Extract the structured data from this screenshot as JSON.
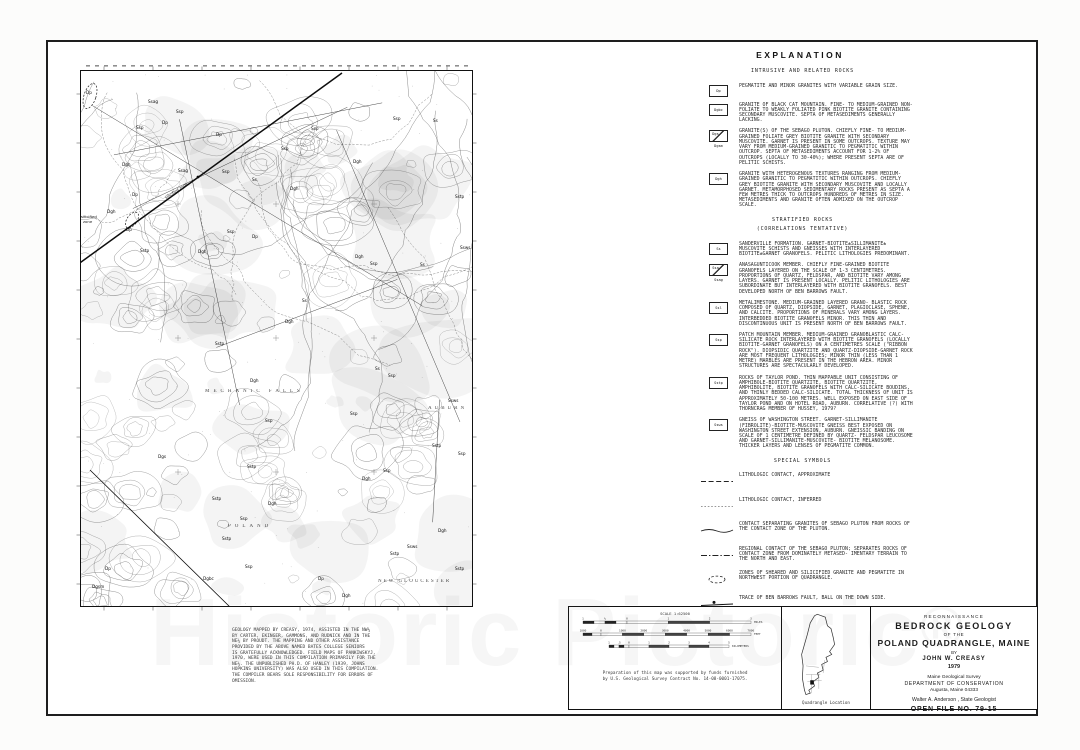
{
  "watermark": {
    "text": "Historic Pictoric",
    "reg": "®"
  },
  "explanation": {
    "title": "EXPLANATION",
    "sections": {
      "intrusive_header": "INTRUSIVE AND RELATED ROCKS",
      "stratified_header": "STRATIFIED ROCKS",
      "stratified_sub": "(CORRELATIONS TENTATIVE)",
      "symbols_header": "SPECIAL SYMBOLS"
    },
    "intrusive": [
      {
        "label": "Dp",
        "text": "PEGMATITE AND MINOR GRANITES WITH VARIABLE GRAIN SIZE."
      },
      {
        "label": "Dgbc",
        "text": "GRANITE OF BLACK CAT MOUNTAIN.  FINE- TO MEDIUM-GRAINED NON-FOLIATE TO WEAKLY FOLIATED PINK BIOTITE GRANITE CONTAINING SECONDARY MUSCOVITE.  SEPTA OF METASEDIMENTS GENERALLY LACKING."
      },
      {
        "label": "Dgs",
        "sublabel": "Dgsm",
        "text": "GRANITE(S) OF THE SEBAGO PLUTON.  CHIEFLY FINE- TO MEDIUM-GRAINED FOLIATE GREY BIOTITE GRANITE WITH SECONDARY MUSCOVITE.  GARNET IS PRESENT IN SOME OUTCROPS.  TEXTURE MAY VARY FROM MEDIUM-GRAINED GRANITIC TO PEGMATITIC WITHIN OUTCROP.  SEPTA OF METASEDIMENTS ACCOUNT FOR 1-2% OF OUTCROPS (LOCALLY TO 30-40%); WHERE PRESENT SEPTA ARE OF PELITIC SCHISTS."
      },
      {
        "label": "Dgh",
        "text": "GRANITE WITH HETEROGENOUS TEXTURES RANGING FROM MEDIUM-GRAINED GRANITIC TO PEGMATITIC WITHIN OUTCROPS.  CHIEFLY GREY BIOTITE GRANITE WITH SECONDARY MUSCOVITE AND LOCALLY GARNET.  METAMORPHOSED SEDIMENTARY ROCKS PRESENT AS SEPTA A FEW METRES THICK TO OUTCROPS HUNDREDS OF METRES IN SIZE.  METASEDIMENTS AND GRANITE OFTEN ADMIXED ON THE OUTCROP SCALE."
      }
    ],
    "stratified": [
      {
        "label": "Ss",
        "text": "SANDERVILLE FORMATION.  GARNET-BIOTITE±SILLIMANITE± MUSCOVITE SCHISTS AND GNEISSES WITH INTERLAYERED BIOTITE±GARNET GRANOFELS.  PELITIC LITHOLOGIES PREDOMINANT."
      },
      {
        "label": "Ssa",
        "sublabel": "Ssag",
        "text": "ANASAGUNTICOOK MEMBER.  CHIEFLY FINE-GRAINED BIOTITE GRANOFELS LAYERED ON THE SCALE OF 1-3 CENTIMETRES. PROPORTIONS OF QUARTZ, FELDSPAR, AND BIOTITE VARY AMONG LAYERS.  GARNET IS PRESENT LOCALLY.  PELITIC LITHOLOGIES ARE SUBORDINATE BUT INTERLAYERED WITH BIOTITE GRANOFELS.  BEST DEVELOPED NORTH OF BEN BARROWS FAULT."
      },
      {
        "label": "Ssl",
        "text": "METALIMESTONE.  MEDIUM-GRAINED LAYERED GRANO- BLASTIC ROCK COMPOSED OF QUARTZ, DIOPSIDE, GARNET, PLAGIOCLASE, SPHENE, AND CALCITE.  PROPORTIONS OF MINERALS VARY AMONG LAYERS.  INTERBEDDED BIOTITE GRANOFELS MINOR.  THIS THIN AND DISCONTINUOUS UNIT IS PRESENT NORTH OF BEN BARROWS FAULT."
      },
      {
        "label": "Ssp",
        "text": "PATCH MOUNTAIN MEMBER.  MEDIUM-GRAINED GRANOBLASTIC CALC-SILICATE ROCK INTERLAYERED WITH BIOTITE GRANOFELS (LOCALLY BIOTITE-GARNET GRANOFELS) ON A CENTIMETRES SCALE (\"RIBBON ROCK\").  DIOPSIDIC QUARTZITE AND QUARTZ-DIOPSIDE-GARNET ROCK ARE MOST FREQUENT LITHOLOGIES; MINOR THIN (LESS THAN 1 METRE) MARBLES ARE PRESENT IN THE HEBRON AREA. MINOR STRUCTURES ARE SPECTACULARLY DEVELOPED."
      },
      {
        "label": "Sstp",
        "text": "ROCKS OF TAYLOR POND.  THIN MAPPABLE UNIT CONSISTING OF AMPHIBOLE-BIOTITE QUARTZITE, BIOTITE QUARTZITE, AMPHIBOLITE, BIOTITE GRANOFELS WITH CALC-SILICATE BOUDINS, AND THINLY BEDDED CALC-SILICATE.  TOTAL THICKNESS OF UNIT IS APPROXIMATELY 50-100 METRES. WELL EXPOSED ON EAST SIDE OF TAYLOR POND AND ON HOTEL ROAD, AUBURN.  CORRELATIVE (?) WITH THORNCRAG MEMBER OF HUSSEY, 1979?"
      },
      {
        "label": "Ssws",
        "text": "GNEISS OF WASHINGTON STREET.  GARNET-SILLIMANITE (FIBROLITE)-BIOTITE-MUSCOVITE GNEISS BEST EXPOSED ON WASHINGTON STREET EXTENSION, AUBURN.  GNEISSIC BANDING ON SCALE OF 1 CENTIMETRE DEFINED BY QUARTZ- FELDSPAR LEUCOSOME AND GARNET-SILLIMANITE-MUSCOVITE- BIOTITE MELANOSOME.  THICKER LAYERS AND LENSES OF PEGMATITE COMMON."
      }
    ],
    "symbols": [
      {
        "type": "dash",
        "text": "LITHOLOGIC CONTACT, APPROXIMATE"
      },
      {
        "type": "dot",
        "text": "LITHOLOGIC CONTACT, INFERRED"
      },
      {
        "type": "solid",
        "text": "CONTACT SEPARATING GRANITES OF SEBAGO PLUTON FROM ROCKS OF THE CONTACT ZONE OF THE PLUTON."
      },
      {
        "type": "dashdot",
        "text": "REGIONAL CONTACT OF THE SEBAGO PLUTON; SEPARATES ROCKS OF CONTACT ZONE FROM DOMINATELY METASED- IMENTARY TERRAIN TO THE NORTH AND EAST."
      },
      {
        "type": "ellipse",
        "text": "ZONES OF SHEARED AND SILICIFIED GRANITE AND PEGMATITE IN NORTHWEST PORTION OF QUADRANGLE."
      },
      {
        "type": "fault",
        "text": "TRACE OF BEN BARROWS FAULT, BALL ON THE DOWN SIDE."
      }
    ]
  },
  "map": {
    "place_names": [
      {
        "t": "MECHANIC FALLS",
        "x": 125,
        "y": 322,
        "ls": 4
      },
      {
        "t": "POLAND",
        "x": 148,
        "y": 457,
        "ls": 4
      },
      {
        "t": "AUBURN",
        "x": 348,
        "y": 339,
        "ls": 3
      },
      {
        "t": "NEW GLOUCESTER",
        "x": 298,
        "y": 512,
        "ls": 2
      }
    ],
    "annotations": [
      {
        "t": "silicified zone",
        "x": 86,
        "y": 129,
        "rot": -33
      },
      {
        "t": "silicified",
        "x": 1,
        "y": 148,
        "rot": 0
      },
      {
        "t": "zone",
        "x": 3,
        "y": 153,
        "rot": 0
      }
    ],
    "unit_labels": [
      {
        "t": "Dp",
        "x": 6,
        "y": 24
      },
      {
        "t": "Ssag",
        "x": 68,
        "y": 33
      },
      {
        "t": "Ssp",
        "x": 96,
        "y": 43
      },
      {
        "t": "Dp",
        "x": 82,
        "y": 54
      },
      {
        "t": "Ssp",
        "x": 56,
        "y": 59
      },
      {
        "t": "Dp",
        "x": 136,
        "y": 66
      },
      {
        "t": "Dgh",
        "x": 42,
        "y": 96
      },
      {
        "t": "Ssag",
        "x": 98,
        "y": 102
      },
      {
        "t": "Ssp",
        "x": 142,
        "y": 103
      },
      {
        "t": "Ss",
        "x": 172,
        "y": 111
      },
      {
        "t": "Dp",
        "x": 52,
        "y": 126
      },
      {
        "t": "Dgh",
        "x": 27,
        "y": 143
      },
      {
        "t": "Dp",
        "x": 46,
        "y": 161
      },
      {
        "t": "Sstp",
        "x": 60,
        "y": 182
      },
      {
        "t": "Ssp",
        "x": 201,
        "y": 80
      },
      {
        "t": "Ssp",
        "x": 231,
        "y": 60
      },
      {
        "t": "Dgh",
        "x": 273,
        "y": 93
      },
      {
        "t": "Ssp",
        "x": 313,
        "y": 50
      },
      {
        "t": "Ss",
        "x": 353,
        "y": 52
      },
      {
        "t": "Sstp",
        "x": 375,
        "y": 128
      },
      {
        "t": "Ssws",
        "x": 380,
        "y": 179
      },
      {
        "t": "Dgh",
        "x": 275,
        "y": 188
      },
      {
        "t": "Ssp",
        "x": 290,
        "y": 195
      },
      {
        "t": "Ss",
        "x": 340,
        "y": 196
      },
      {
        "t": "Dgh",
        "x": 210,
        "y": 120
      },
      {
        "t": "Dp",
        "x": 172,
        "y": 168
      },
      {
        "t": "Ssp",
        "x": 147,
        "y": 163
      },
      {
        "t": "Dgh",
        "x": 118,
        "y": 183
      },
      {
        "t": "Ss",
        "x": 222,
        "y": 232
      },
      {
        "t": "Dgh",
        "x": 205,
        "y": 253
      },
      {
        "t": "Sstp",
        "x": 135,
        "y": 275
      },
      {
        "t": "Dgh",
        "x": 170,
        "y": 312
      },
      {
        "t": "Ssp",
        "x": 185,
        "y": 352
      },
      {
        "t": "Dgs",
        "x": 78,
        "y": 388
      },
      {
        "t": "Sstp",
        "x": 167,
        "y": 398
      },
      {
        "t": "Sstp",
        "x": 132,
        "y": 430
      },
      {
        "t": "Dgh",
        "x": 188,
        "y": 435
      },
      {
        "t": "Ssp",
        "x": 160,
        "y": 450
      },
      {
        "t": "Sstp",
        "x": 142,
        "y": 470
      },
      {
        "t": "Ssp",
        "x": 165,
        "y": 498
      },
      {
        "t": "Dgbc",
        "x": 123,
        "y": 510
      },
      {
        "t": "Dp",
        "x": 238,
        "y": 510
      },
      {
        "t": "Dgh",
        "x": 262,
        "y": 527
      },
      {
        "t": "Ssp",
        "x": 270,
        "y": 345
      },
      {
        "t": "Dgh",
        "x": 282,
        "y": 410
      },
      {
        "t": "Ssws",
        "x": 327,
        "y": 478
      },
      {
        "t": "Sstp",
        "x": 310,
        "y": 485
      },
      {
        "t": "Ssp",
        "x": 303,
        "y": 402
      },
      {
        "t": "Ss",
        "x": 295,
        "y": 300
      },
      {
        "t": "Ssp",
        "x": 308,
        "y": 307
      },
      {
        "t": "Ssws",
        "x": 368,
        "y": 332
      },
      {
        "t": "Sstp",
        "x": 352,
        "y": 377
      },
      {
        "t": "Ssp",
        "x": 378,
        "y": 385
      },
      {
        "t": "Dgh",
        "x": 358,
        "y": 462
      },
      {
        "t": "Sstp",
        "x": 375,
        "y": 500
      },
      {
        "t": "Dgsm",
        "x": 12,
        "y": 518
      },
      {
        "t": "Dp",
        "x": 25,
        "y": 500
      }
    ]
  },
  "credits": "GEOLOGY MAPPED BY CREASY, 1974, ASSISTED IN THE NW¼\nBY CARTER, EKINGER, GAMMONS, AND RUDNICK AND IN THE\nNE¼ BY PROUDT.  THE MAPPING AND OTHER ASSISTANCE\nPROVIDED BY THE ABOVE NAMED BATES COLLEGE SENIORS\nIS GRATEFULLY ACKNOWLEDGED.  FIELD MAPS OF PANKIWSKYJ,\n1970, WERE USED IN THIS COMPILATION PRIMARILY FOR THE\nNE¼.  THE UNPUBLISHED PH.D. OF HANLEY (1939, JOHNS\nHOPKINS UNIVERSITY) WAS ALSO USED IN THIS COMPILATION.\nTHE COMPILER BEARS SOLE RESPONSIBILITY FOR ERRORS OF\nOMISSION.",
  "scale_panel": {
    "scale_label": "SCALE 1:62500",
    "miles": [
      "1",
      "½",
      "0",
      "1",
      "2",
      "3"
    ],
    "miles_unit": "MILES",
    "feet": [
      "1000",
      "0",
      "1000",
      "2000",
      "3000",
      "4000",
      "5000",
      "6000",
      "7000"
    ],
    "feet_unit": "FEET",
    "km": [
      "1",
      ".5",
      "0",
      "1",
      "2",
      "3",
      "4",
      "5"
    ],
    "km_unit": "KILOMETERS",
    "support_note": "Preparation of this map was supported by funds furnished\nby U.S. Geological Survey Contract No. 14-08-0001-17075."
  },
  "location_panel": {
    "caption": "Quadrangle Location"
  },
  "title_block": {
    "reconnaissance": "RECONNAISSANCE",
    "title1": "BEDROCK GEOLOGY",
    "of_the": "OF THE",
    "title2": "POLAND QUADRANGLE, MAINE",
    "by": "BY",
    "author": "JOHN W. CREASY",
    "year": "1979",
    "org1": "Maine Geological Survey",
    "org2": "DEPARTMENT OF CONSERVATION",
    "org3": "Augusta, Maine  04333",
    "geologist": "Walter A. Anderson ,  State Geologist",
    "open_file": "OPEN FILE NO. 79-15"
  }
}
